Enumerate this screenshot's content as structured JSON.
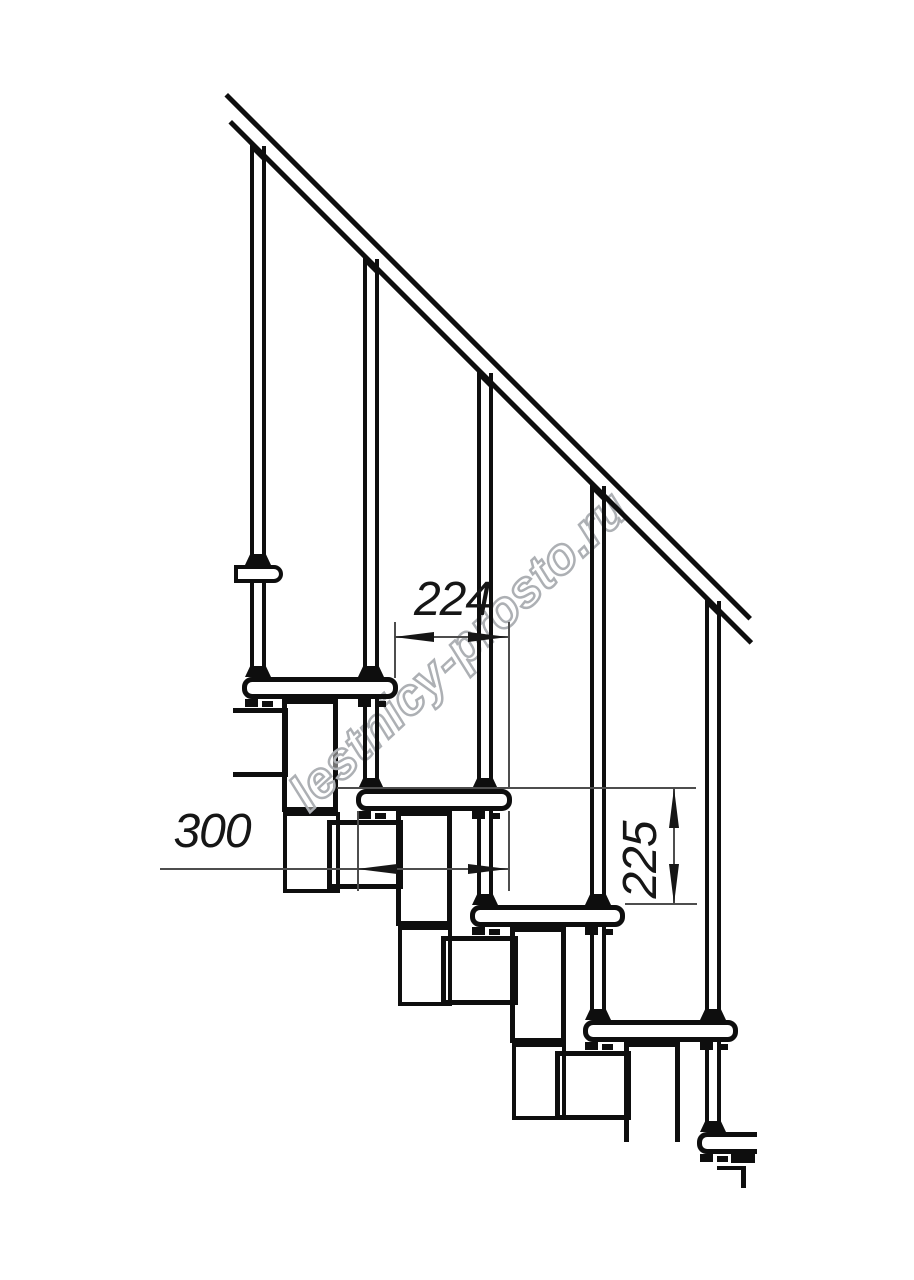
{
  "drawing": {
    "type": "modular staircase side elevation, technical line drawing",
    "background": "#ffffff",
    "ink_color": "#0e0e0e",
    "thin_line_color": "#4d4d4d"
  },
  "dimensions": {
    "step_run": {
      "label": "224"
    },
    "tread_depth": {
      "label": "300"
    },
    "step_rise": {
      "label": "225"
    }
  },
  "watermark": {
    "text": "lestnicy-prosto.ru",
    "color": "#adb0b4"
  }
}
